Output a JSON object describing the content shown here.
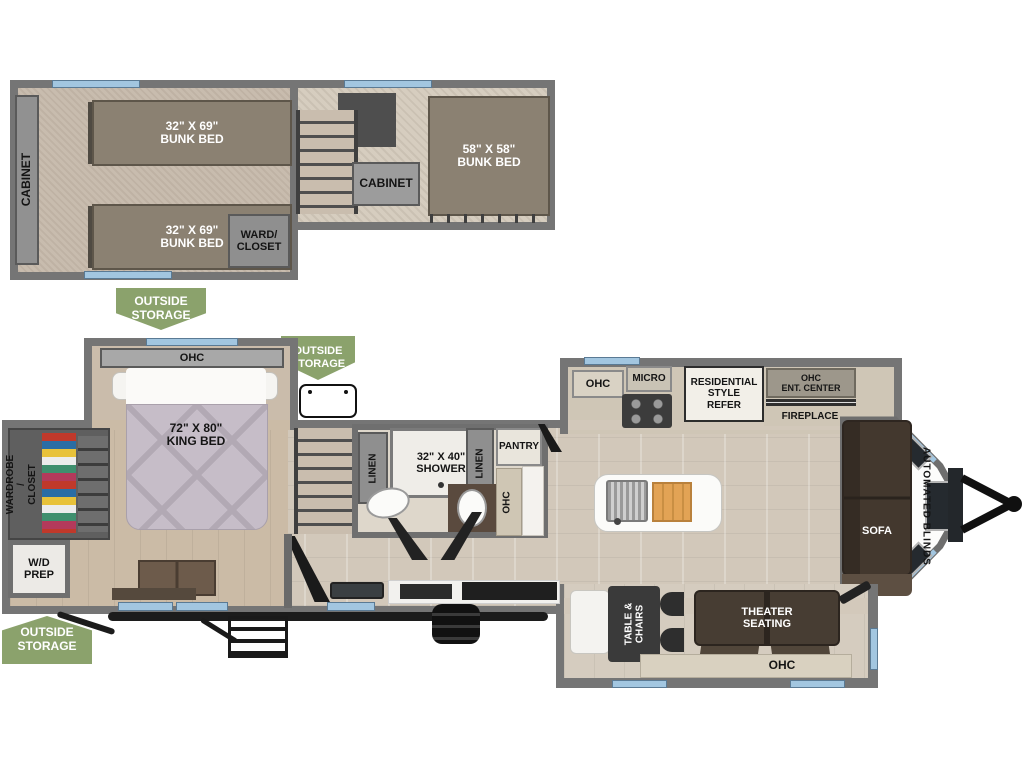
{
  "loft": {
    "cabinet_side": "CABINET",
    "bunk_top": "32\" X 69\"\nBUNK BED",
    "bunk_bottom": "32\" X 69\"\nBUNK BED",
    "ward_closet": "WARD/\nCLOSET",
    "cabinet_mid": "CABINET",
    "bunk_rear": "58\" X 58\"\nBUNK BED"
  },
  "badges": {
    "outside_storage_top": "OUTSIDE\nSTORAGE",
    "outside_storage_mid": "OUTSIDE\nSTORAGE",
    "outside_storage_bottom": "OUTSIDE\nSTORAGE"
  },
  "bedroom": {
    "ohc": "OHC",
    "king_bed": "72\" X 80\"\nKING BED",
    "wardrobe": "WARDROBE /\nCLOSET",
    "wd_prep": "W/D\nPREP"
  },
  "bathroom": {
    "linen_left": "LINEN",
    "shower": "32\" X 40\"\nSHOWER",
    "linen_right": "LINEN",
    "pantry": "PANTRY",
    "ohc": "OHC"
  },
  "kitchen": {
    "ohc": "OHC",
    "micro": "MICRO",
    "refer": "RESIDENTIAL\nSTYLE\nREFER",
    "ent_center": "OHC\nENT. CENTER",
    "fireplace": "FIREPLACE"
  },
  "living": {
    "sofa": "SOFA",
    "automated_blinds": "AUTOMATED BLINDS"
  },
  "dinette": {
    "table_chairs": "TABLE &\nCHAIRS",
    "theater_seating": "THEATER\nSEATING",
    "ohc": "OHC"
  },
  "colors": {
    "badge_green": "#8ba26c",
    "window_blue": "#a2c6e0",
    "wall_gray": "#757575"
  }
}
